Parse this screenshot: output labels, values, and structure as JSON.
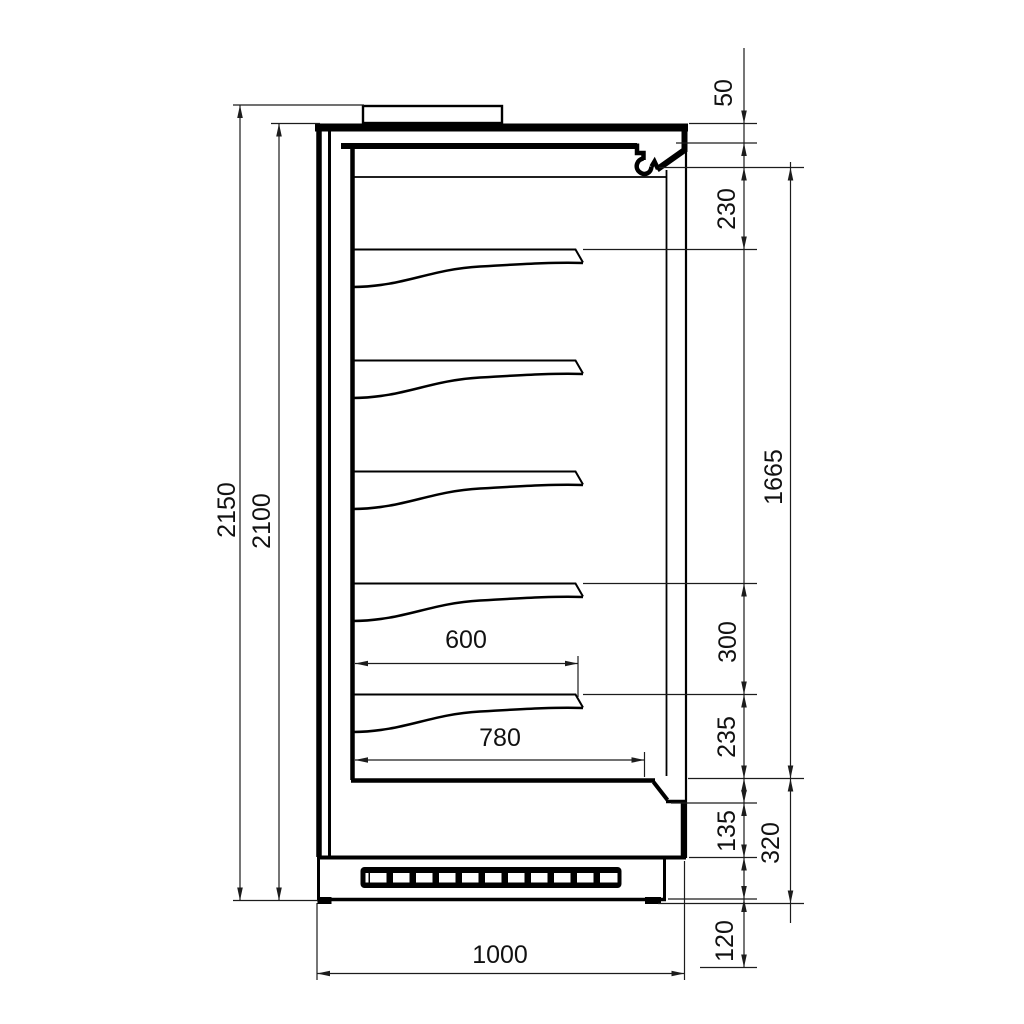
{
  "drawing": {
    "background_color": "#ffffff",
    "line_color": "#000000",
    "dimension_line_color": "#1c1c1c"
  },
  "labels": {
    "overall_height": "2150",
    "body_height": "2100",
    "canopy_lip": "50",
    "top_clearance": "230",
    "opening_height": "1665",
    "shelf_spacing": "300",
    "bottom_shelf_clearance": "235",
    "front_panel_height": "135",
    "base_section_height": "320",
    "plinth_height": "120",
    "shelf_depth": "600",
    "deck_depth": "780",
    "overall_depth": "1000"
  },
  "structure": {
    "shelf_count": 5,
    "grille_slot_count": 11
  }
}
